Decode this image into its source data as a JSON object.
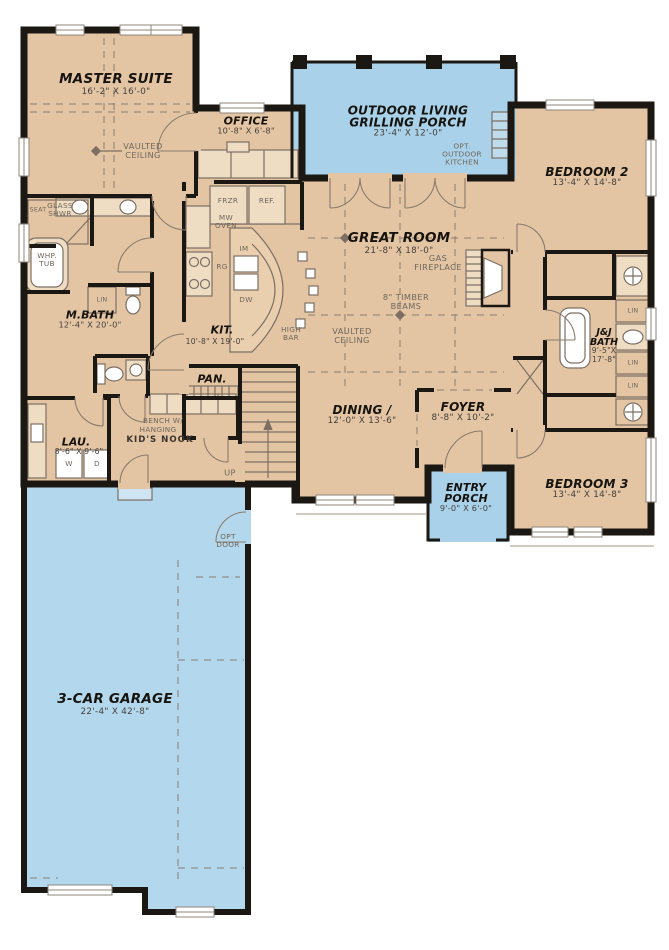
{
  "colors": {
    "floor_tan": "#e3c5a4",
    "porch_blue": "#a9d2ea",
    "garage_blue": "#b3d8ee",
    "wall_black": "#1b1712",
    "line_gray": "#7d6f63"
  },
  "rooms": {
    "master_suite": {
      "name": "MASTER SUITE",
      "dims": "16'-2\" X 16'-0\""
    },
    "office": {
      "name": "OFFICE",
      "dims": "10'-8\" X 6'-8\""
    },
    "outdoor_living": {
      "name1": "OUTDOOR LIVING",
      "name2": "GRILLING PORCH",
      "dims": "23'-4\" X 12'-0\""
    },
    "bedroom2": {
      "name": "BEDROOM 2",
      "dims": "13'-4\" X 14'-8\""
    },
    "great_room": {
      "name": "GREAT ROOM",
      "dims": "21'-8\" X 18'-0\""
    },
    "kitchen": {
      "name": "KIT.",
      "dims": "10'-8\" X 19'-0\""
    },
    "mbath": {
      "name": "M.BATH",
      "dims": "12'-4\" X 20'-0\""
    },
    "laundry": {
      "name": "LAU.",
      "dims": "8'-6\" X 9'-6\""
    },
    "pantry": {
      "name": "PAN."
    },
    "dining": {
      "name": "DINING /",
      "dims": "12'-0\" X 13'-6\""
    },
    "foyer": {
      "name": "FOYER",
      "dims": "8'-8\" X 10'-2\""
    },
    "entry_porch": {
      "name1": "ENTRY",
      "name2": "PORCH",
      "dims": "9'-0\" X 6'-0\""
    },
    "bedroom3": {
      "name": "BEDROOM 3",
      "dims": "13'-4\" X 14'-8\""
    },
    "jj_bath": {
      "name1": "J&J",
      "name2": "BATH",
      "dims1": "9'-5\"X",
      "dims2": "17'-8\""
    },
    "garage": {
      "name": "3-CAR GARAGE",
      "dims": "22'-4\" X 42'-8\""
    }
  },
  "labels": {
    "vaulted1": "VAULTED",
    "vaulted2": "CEILING",
    "gas1": "GAS",
    "gas2": "FIREPLACE",
    "beams1": "8\" TIMBER",
    "beams2": "BEAMS",
    "optkit1": "OPT.",
    "optkit2": "OUTDOOR",
    "optkit3": "KITCHEN",
    "optdoor1": "OPT",
    "optdoor2": "DOOR",
    "bench1": "BENCH W/",
    "bench2": "HANGING",
    "nook": "KID'S NOOK",
    "glass1": "GLASS",
    "glass2": "SHWR",
    "seat": "SEAT",
    "whp1": "WHP.",
    "whp2": "TUB",
    "lin": "LIN",
    "frzr": "FRZR",
    "ref": "REF.",
    "mw1": "MW",
    "mw2": "OVEN",
    "rg": "RG",
    "dw": "DW",
    "im": "IM",
    "high1": "HIGH",
    "high2": "BAR",
    "up": "UP",
    "washer": "W",
    "dryer": "D"
  }
}
